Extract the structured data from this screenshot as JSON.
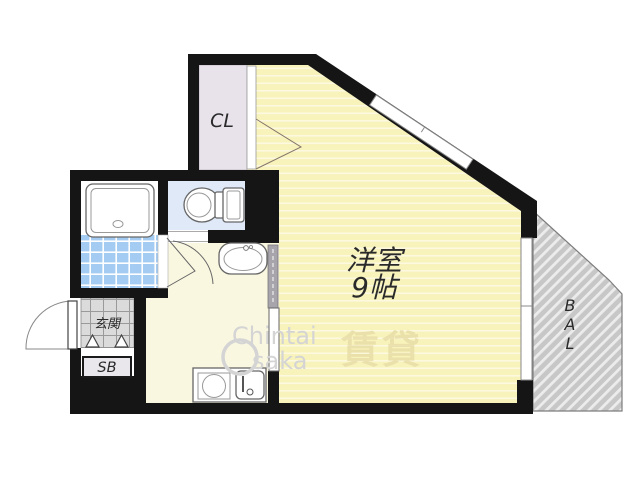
{
  "labels": {
    "main_room_name": "洋室",
    "main_room_size": "9帖",
    "closet": "CL",
    "balcony": {
      "chars": [
        "B",
        "A",
        "L"
      ]
    },
    "entrance": "玄関",
    "shoe_box": "SB"
  },
  "watermark": {
    "line1": "Chintai",
    "line2": "saka",
    "stamp": "賃貸"
  },
  "colors": {
    "wall": "#151515",
    "room_fill": "#f8f2bb",
    "room_stripe": "rgba(255,255,255,0.55)",
    "hall_fill": "#faf7e1",
    "closet_fill": "#e8e2ea",
    "toilet_fill": "#dfe9f7",
    "bath_tile": "#a4ccf2",
    "tile_line": "#ffffff",
    "genkan_fill": "#dbdbdb",
    "genkan_line": "#9a9a9a",
    "balcony_fill": "#c7c7c7",
    "balcony_stripe": "#ececec",
    "balcony_edge": "#7d7d7d",
    "sb_fill": "#e9e7ec",
    "fixture_stroke": "#666666",
    "label_color": "#2a2a2a",
    "wm_gray": "#d4d4d4",
    "wm_yellow": "#e7dca6"
  }
}
